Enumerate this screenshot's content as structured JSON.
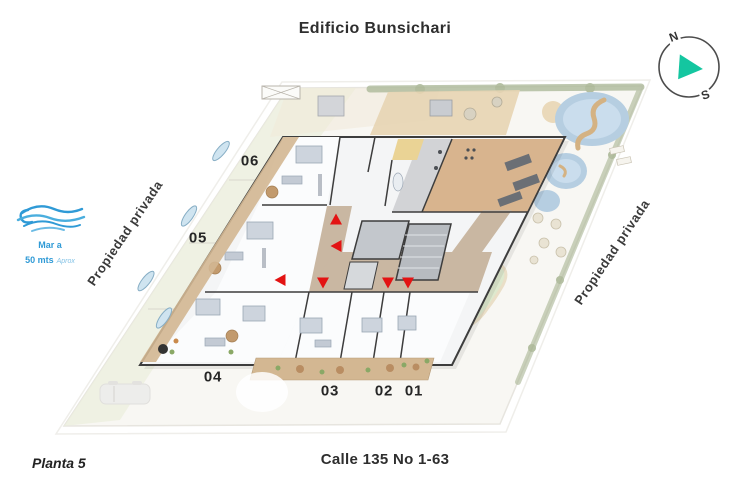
{
  "title": "Edificio Bunsichari",
  "plan_label": "Planta 5",
  "street_label": "Calle 135 No 1-63",
  "left_boundary_label": "Propiedad privada",
  "right_boundary_label": "Propiedad privada",
  "sea_note": {
    "line1": "Mar a",
    "line2": "50 mts",
    "line3": "Aprox"
  },
  "compass": {
    "north": "N",
    "south": "S",
    "arrow_color": "#14c6a0"
  },
  "units": [
    {
      "id": "06",
      "x": 250,
      "y": 161
    },
    {
      "id": "05",
      "x": 198,
      "y": 238
    },
    {
      "id": "04",
      "x": 213,
      "y": 377
    },
    {
      "id": "03",
      "x": 330,
      "y": 391
    },
    {
      "id": "02",
      "x": 384,
      "y": 391
    },
    {
      "id": "01",
      "x": 414,
      "y": 391
    }
  ],
  "entrance_arrows": [
    {
      "x": 336,
      "y": 219,
      "dir": "up"
    },
    {
      "x": 336,
      "y": 246,
      "dir": "left"
    },
    {
      "x": 280,
      "y": 280,
      "dir": "left"
    },
    {
      "x": 323,
      "y": 283,
      "dir": "down"
    },
    {
      "x": 388,
      "y": 283,
      "dir": "down"
    },
    {
      "x": 408,
      "y": 283,
      "dir": "down"
    }
  ],
  "colors": {
    "entrance_red": "#e31313",
    "sea_blue": "#2f9ad6",
    "compass_teal": "#14c6a0",
    "corridor_tan": "#c9b7a2",
    "gym_wood": "#d8b48e",
    "pool_blue": "#b6cee1",
    "hedge_green": "#a9b694",
    "wall_dark": "#3d3d3d"
  }
}
